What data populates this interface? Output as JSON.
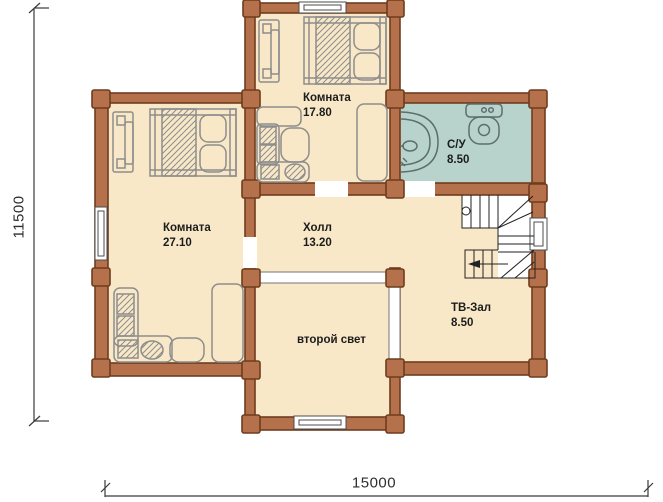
{
  "plan": {
    "rooms": [
      {
        "name": "Комната",
        "area": "17.80"
      },
      {
        "name": "Комната",
        "area": "27.10"
      },
      {
        "name": "Холл",
        "area": "13.20"
      },
      {
        "name": "С/У",
        "area": "8.50"
      },
      {
        "name": "ТВ-Зал",
        "area": "8.50"
      },
      {
        "name": "второй свет",
        "area": ""
      }
    ],
    "dimensions": {
      "height_mm": "11500",
      "width_mm": "15000"
    },
    "colors": {
      "wall": "#b5714b",
      "wall_outline": "#6f3d1e",
      "floor": "#f9e8c7",
      "bathroom_floor": "#b7d3cc",
      "furniture_line": "#8d8d8d",
      "stair_line": "#222222",
      "text": "#1c1c1c"
    }
  }
}
